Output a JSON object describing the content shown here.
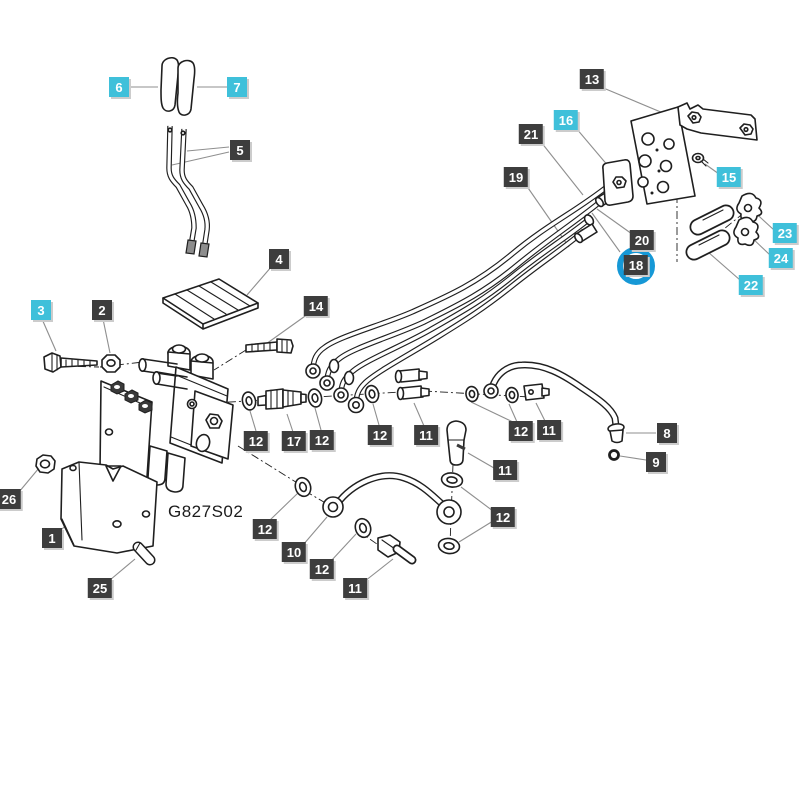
{
  "figure": {
    "part_code": "G827S02"
  },
  "colors": {
    "background": "#ffffff",
    "line_art": "#1f1f1f",
    "leader": "#8f8f8f",
    "callout_dark_bg": "#3d3d3d",
    "callout_cyan_bg": "#3fc0da",
    "callout_text": "#ffffff",
    "callout_shadow": "#cccccc",
    "highlight_ring": "#1698d6"
  },
  "highlight": {
    "highlighted_callout": "18"
  },
  "callouts": [
    {
      "num": "6",
      "type": "cyan"
    },
    {
      "num": "7",
      "type": "cyan"
    },
    {
      "num": "5",
      "type": "dark"
    },
    {
      "num": "4",
      "type": "dark"
    },
    {
      "num": "3",
      "type": "cyan"
    },
    {
      "num": "2",
      "type": "dark"
    },
    {
      "num": "14",
      "type": "dark"
    },
    {
      "num": "13",
      "type": "dark"
    },
    {
      "num": "16",
      "type": "cyan"
    },
    {
      "num": "21",
      "type": "dark"
    },
    {
      "num": "19",
      "type": "dark"
    },
    {
      "num": "15",
      "type": "cyan"
    },
    {
      "num": "20",
      "type": "dark"
    },
    {
      "num": "18",
      "type": "dark",
      "highlighted": true
    },
    {
      "num": "23",
      "type": "cyan"
    },
    {
      "num": "24",
      "type": "cyan"
    },
    {
      "num": "22",
      "type": "cyan"
    },
    {
      "num": "12",
      "type": "dark"
    },
    {
      "num": "17",
      "type": "dark"
    },
    {
      "num": "12",
      "type": "dark"
    },
    {
      "num": "12",
      "type": "dark"
    },
    {
      "num": "11",
      "type": "dark"
    },
    {
      "num": "12",
      "type": "dark"
    },
    {
      "num": "11",
      "type": "dark"
    },
    {
      "num": "11",
      "type": "dark"
    },
    {
      "num": "12",
      "type": "dark"
    },
    {
      "num": "8",
      "type": "dark"
    },
    {
      "num": "9",
      "type": "dark"
    },
    {
      "num": "12",
      "type": "dark"
    },
    {
      "num": "10",
      "type": "dark"
    },
    {
      "num": "12",
      "type": "dark"
    },
    {
      "num": "11",
      "type": "dark"
    },
    {
      "num": "1",
      "type": "dark"
    },
    {
      "num": "25",
      "type": "dark"
    },
    {
      "num": "26",
      "type": "dark"
    }
  ]
}
